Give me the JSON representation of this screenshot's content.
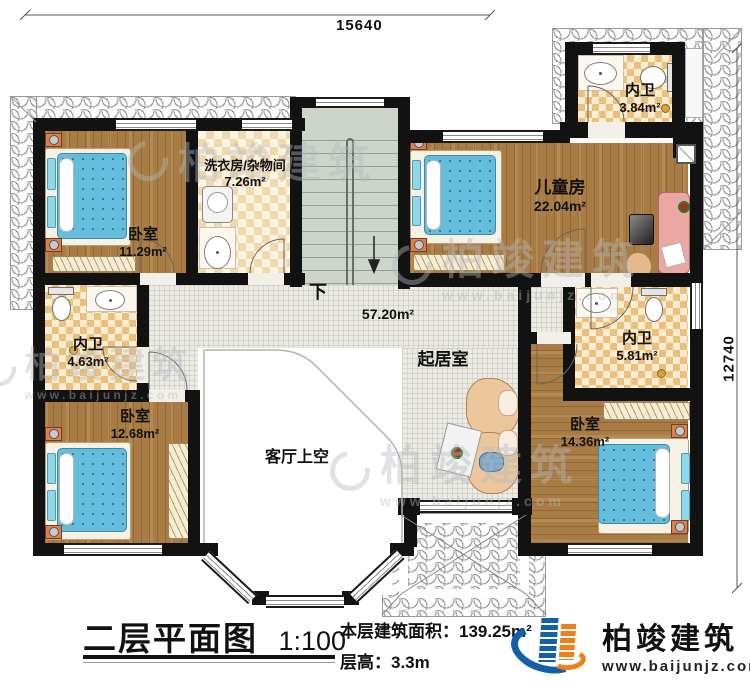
{
  "plan": {
    "dimensions": {
      "width_mm": "15640",
      "height_mm": "12740"
    },
    "stairs": {
      "direction_label": "下"
    },
    "rooms": {
      "bedroom_top_left": {
        "name": "卧室",
        "area": "11.29m²"
      },
      "laundry": {
        "name": "洗衣房/杂物间",
        "area": "7.26m²"
      },
      "kids_room": {
        "name": "儿童房",
        "area": "22.04m²"
      },
      "bath_top": {
        "name": "内卫",
        "area": "3.84m²"
      },
      "bath_left": {
        "name": "内卫",
        "area": "4.63m²"
      },
      "bath_right": {
        "name": "内卫",
        "area": "5.81m²"
      },
      "bedroom_bottom_left": {
        "name": "卧室",
        "area": "12.68m²"
      },
      "bedroom_bottom_right": {
        "name": "卧室",
        "area": "14.36m²"
      },
      "living": {
        "name": "起居室",
        "area": "57.20m²"
      },
      "void_over_living": {
        "name": "客厅上空"
      }
    }
  },
  "title_block": {
    "title": "二层平面图",
    "scale": "1:100",
    "area_label": "本层建筑面积：",
    "area_value": "139.25m²",
    "height_label": "层高：",
    "height_value": "3.3m"
  },
  "brand": {
    "name": "柏竣建筑",
    "url": "www.baijunjz.com"
  },
  "watermark": {
    "text": "柏竣建筑",
    "url": "www.baijunjz.com"
  },
  "colors": {
    "wall": "#121212",
    "wood_floor": "#a87c44",
    "tile_checker": "#ecc07c",
    "corridor": "#ebebe4",
    "stair": "#cdd5ca",
    "bed_blue": "#64bddc",
    "nightstand_orange": "#d98050",
    "brand_blue": "#1360a8",
    "brand_orange": "#f07f1a"
  }
}
